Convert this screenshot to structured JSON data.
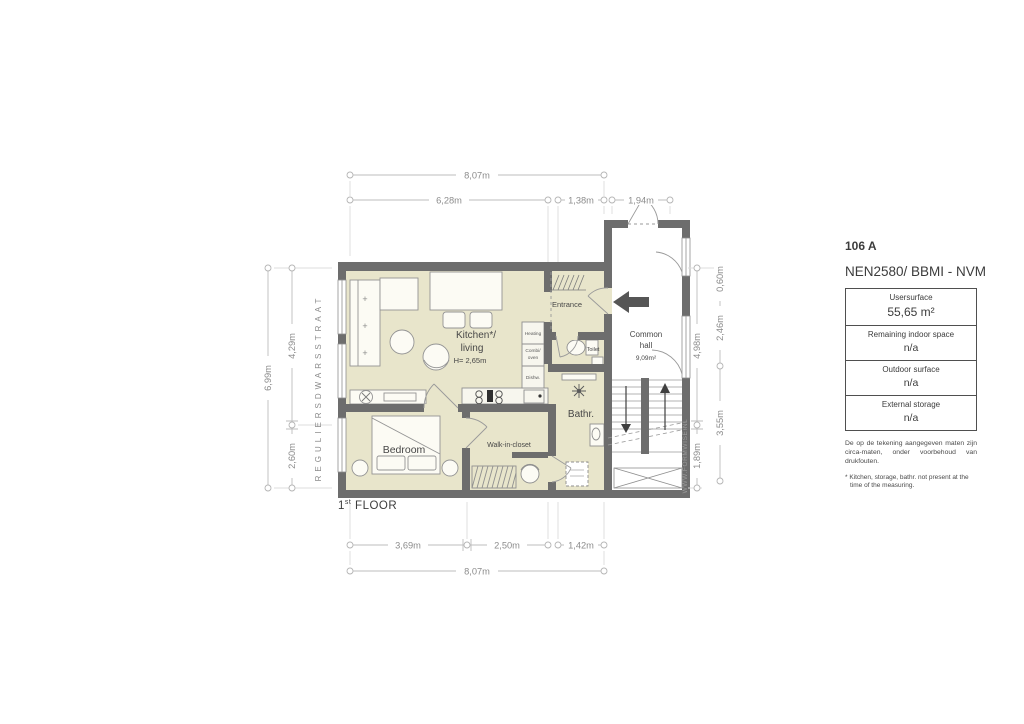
{
  "title_block": {
    "unit_number": "106 A",
    "standard": "NEN2580/ BBMI - NVM",
    "rows": [
      {
        "label": "Usersurface",
        "value": "55,65 m²"
      },
      {
        "label": "Remaining indoor space",
        "value": "n/a"
      },
      {
        "label": "Outdoor surface",
        "value": "n/a"
      },
      {
        "label": "External storage",
        "value": "n/a"
      }
    ],
    "disclaimer": "De op de tekening aangegeven maten zijn circa-maten, onder voorbehoud van drukfouten.",
    "footnote": "* Kitchen, storage, bathr. not present at the time of the measuring."
  },
  "floor_label": {
    "number": "1",
    "sup": "st",
    "word": " FLOOR"
  },
  "street_name": "REGULIERSDWARSSTRAAT",
  "watermark": "WWW.FORMWISE.NL",
  "rooms": {
    "kitchen_living_1": "Kitchen*/",
    "kitchen_living_2": "living",
    "kitchen_living_height": "H= 2,65m",
    "entrance": "Entrance",
    "toilet": "Toilet",
    "bathroom": "Bathr.",
    "bedroom": "Bedroom",
    "walk_in_closet": "Walk-in-closet",
    "common_hall_1": "Common",
    "common_hall_2": "hall",
    "common_hall_area": "9,09m²"
  },
  "appliances": {
    "top": "Heating",
    "mid1": "Combi/",
    "mid2": "oven",
    "bottom": "Dishw."
  },
  "marks": {
    "plus": "+"
  },
  "dimensions": {
    "top_total": "8,07m",
    "top_seg1": "6,28m",
    "top_seg2": "1,38m",
    "top_seg3": "1,94m",
    "bottom_seg1": "3,69m",
    "bottom_seg2": "2,50m",
    "bottom_seg3": "1,42m",
    "bottom_total": "8,07m",
    "left_total": "6,99m",
    "left_seg1": "4,29m",
    "left_seg2": "2,60m",
    "right_inner1": "4,98m",
    "right_inner2": "1,89m",
    "right_outer1": "0,60m",
    "right_outer2": "2,46m",
    "right_outer3": "3,55m"
  }
}
